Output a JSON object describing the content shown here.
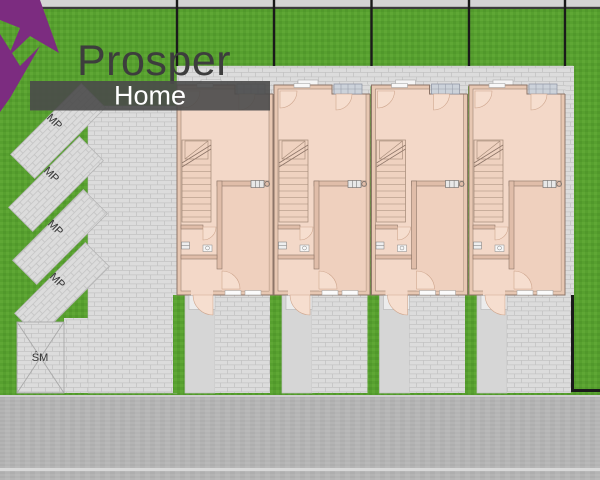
{
  "logo": {
    "brand": "Prosper",
    "sub_brand": "Home"
  },
  "parking": {
    "spaces": [
      {
        "label": "MP"
      },
      {
        "label": "MP"
      },
      {
        "label": "MP"
      },
      {
        "label": "MP"
      }
    ]
  },
  "trash_area": {
    "label": "ŚM"
  },
  "houses": {
    "count": "4"
  },
  "colors": {
    "grass": "#57a02f",
    "grass_light": "#63aa38",
    "grass_dark": "#4e9429",
    "paving": "#dcdcdc",
    "paving_line": "#c3c3c3",
    "walkway": "#d6d6d6",
    "road": "#b4b4b4",
    "road_edge": "#3c3c3c",
    "house_floor": "#f3d8c8",
    "house_wall": "#e7c7b2",
    "wall_stroke": "#8d7568",
    "door_leaf": "#f6decf",
    "logo_purple": "#7c2c80",
    "banner_gray": "#4a4a4a",
    "text_dark": "#3d3d3d",
    "fence_black": "#1a1a1a"
  }
}
